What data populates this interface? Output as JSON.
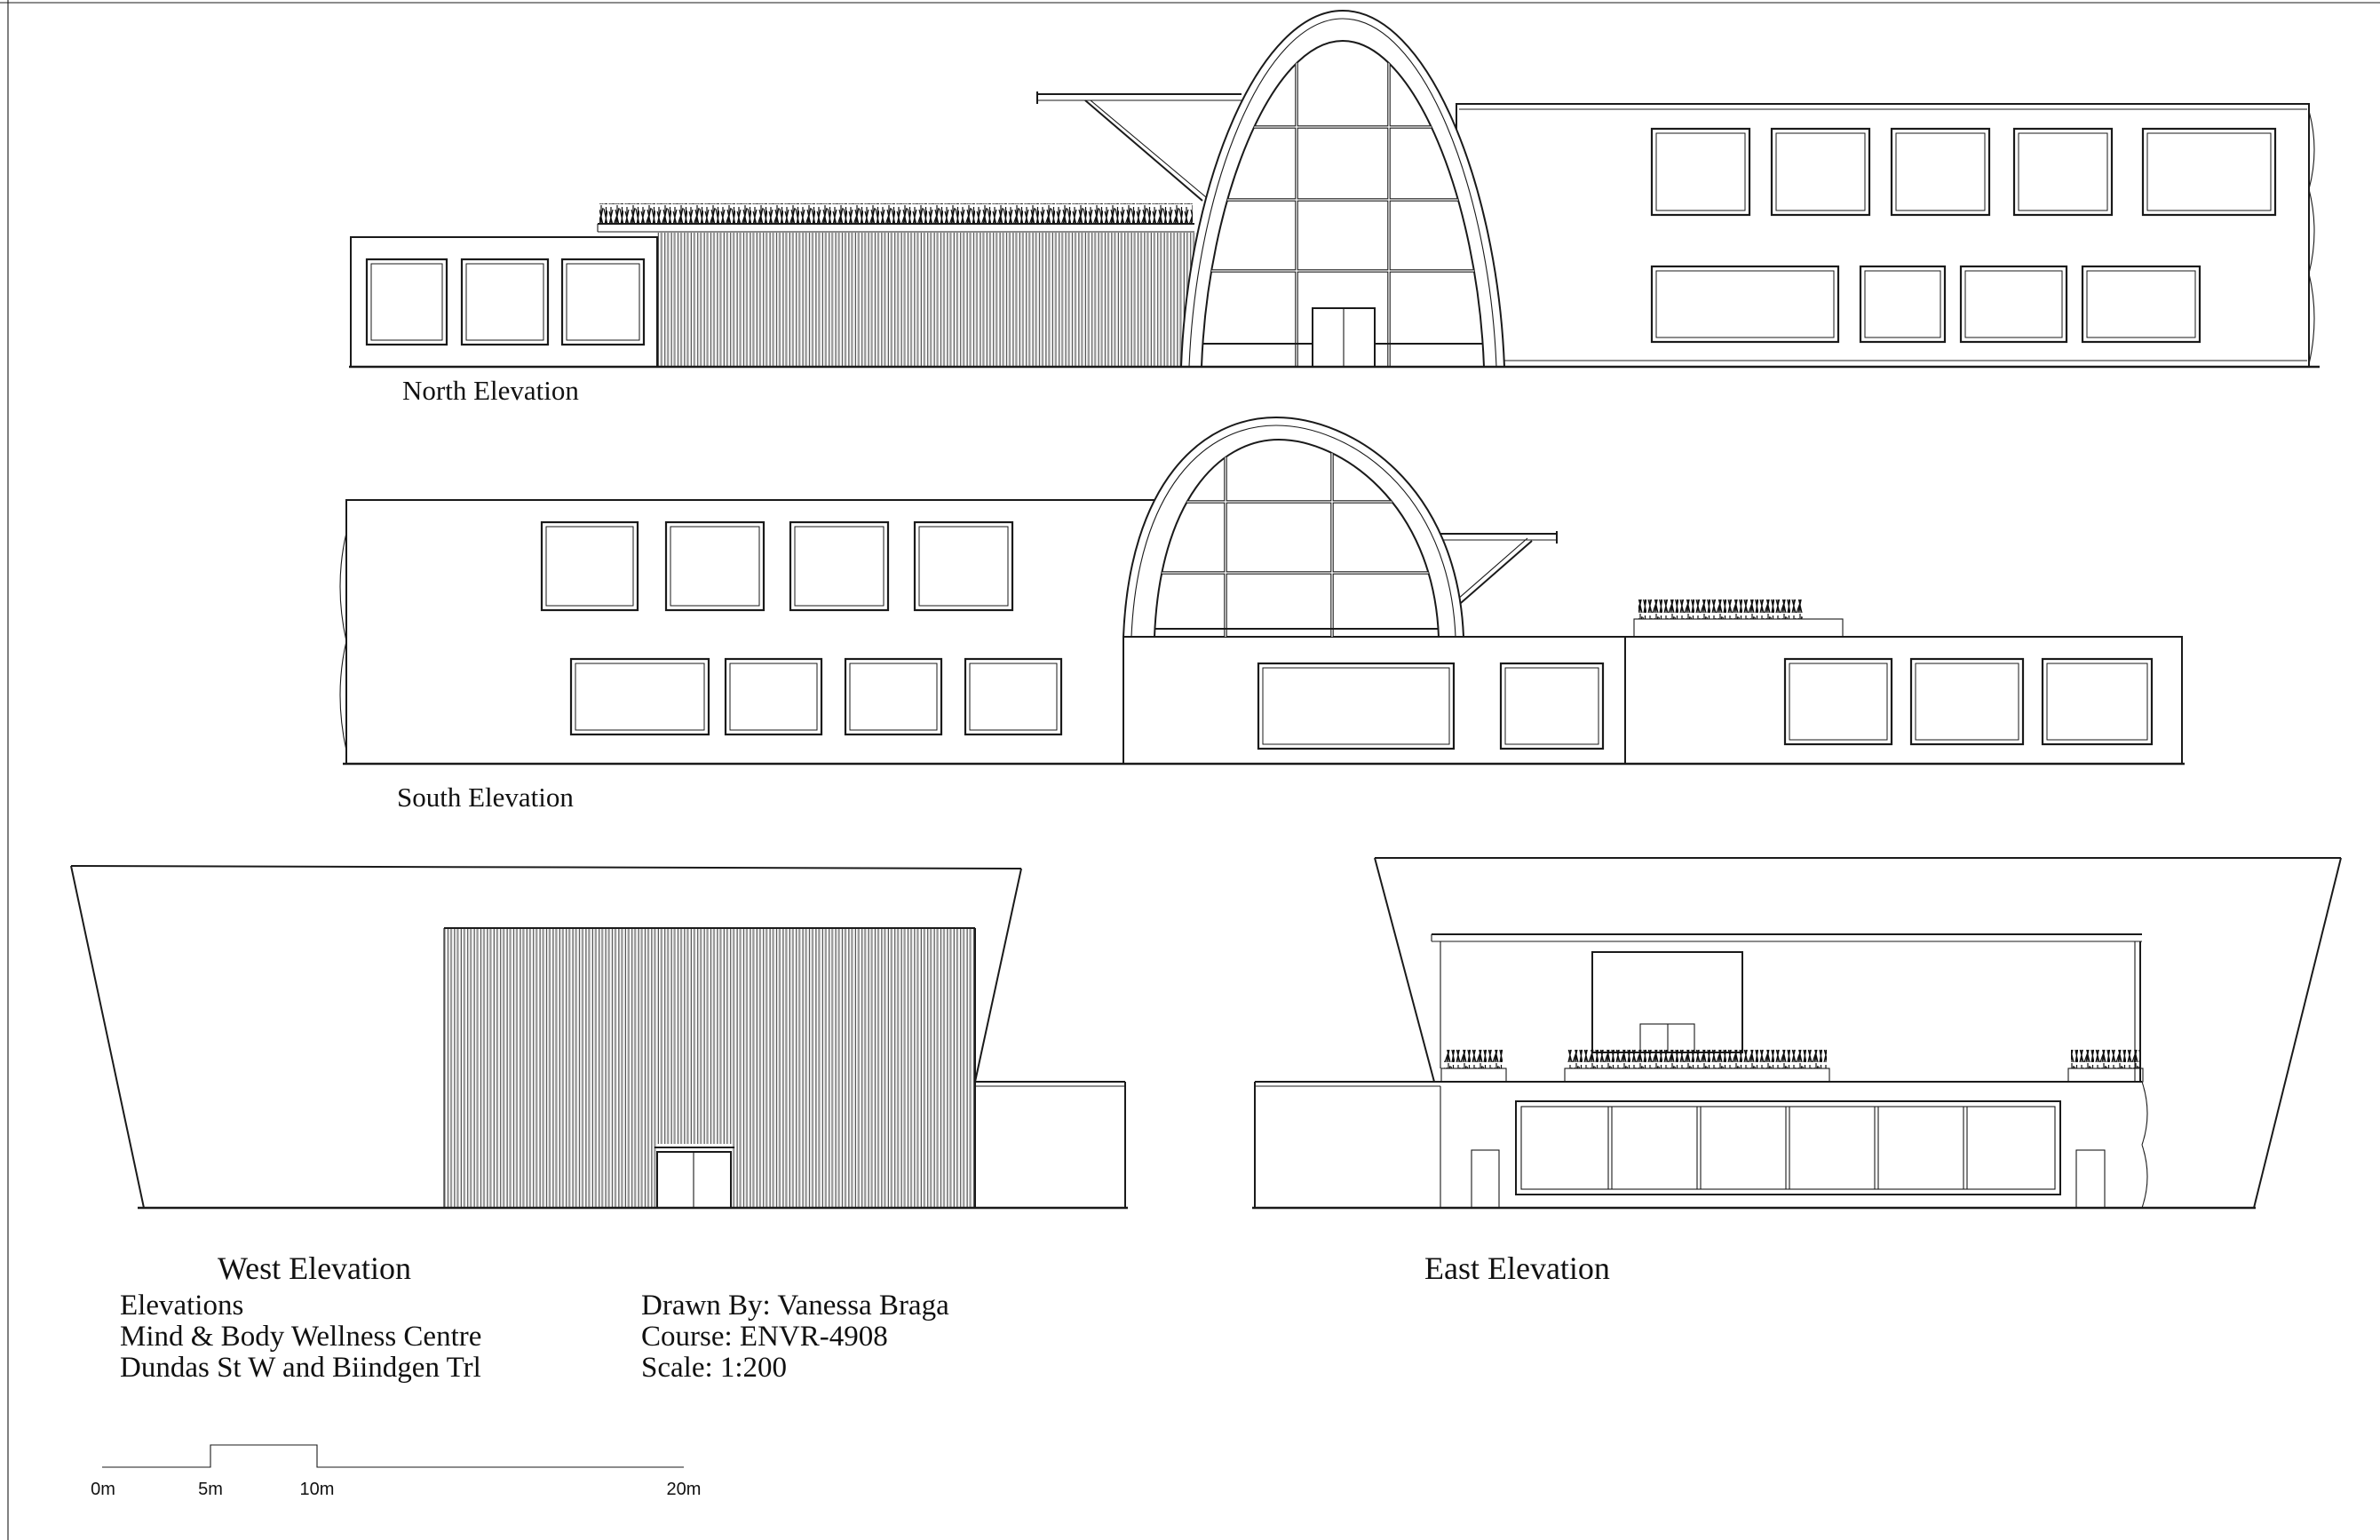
{
  "sheet": {
    "type": "architectural-elevations-drawing",
    "background_color": "#ffffff",
    "line_color": "#1a1a1a"
  },
  "elevations": {
    "north": {
      "label": "North Elevation"
    },
    "south": {
      "label": "South Elevation"
    },
    "west": {
      "label": "West Elevation"
    },
    "east": {
      "label": "East Elevation"
    }
  },
  "title_block": {
    "drawing_title": "Elevations",
    "project_name": "Mind & Body Wellness Centre",
    "location": "Dundas St W and Biindgen Trl",
    "drawn_by": "Drawn By: Vanessa Braga",
    "course": "Course: ENVR-4908",
    "scale": "Scale: 1:200"
  },
  "scale_bar": {
    "labels": [
      "0m",
      "5m",
      "10m",
      "20m"
    ]
  }
}
